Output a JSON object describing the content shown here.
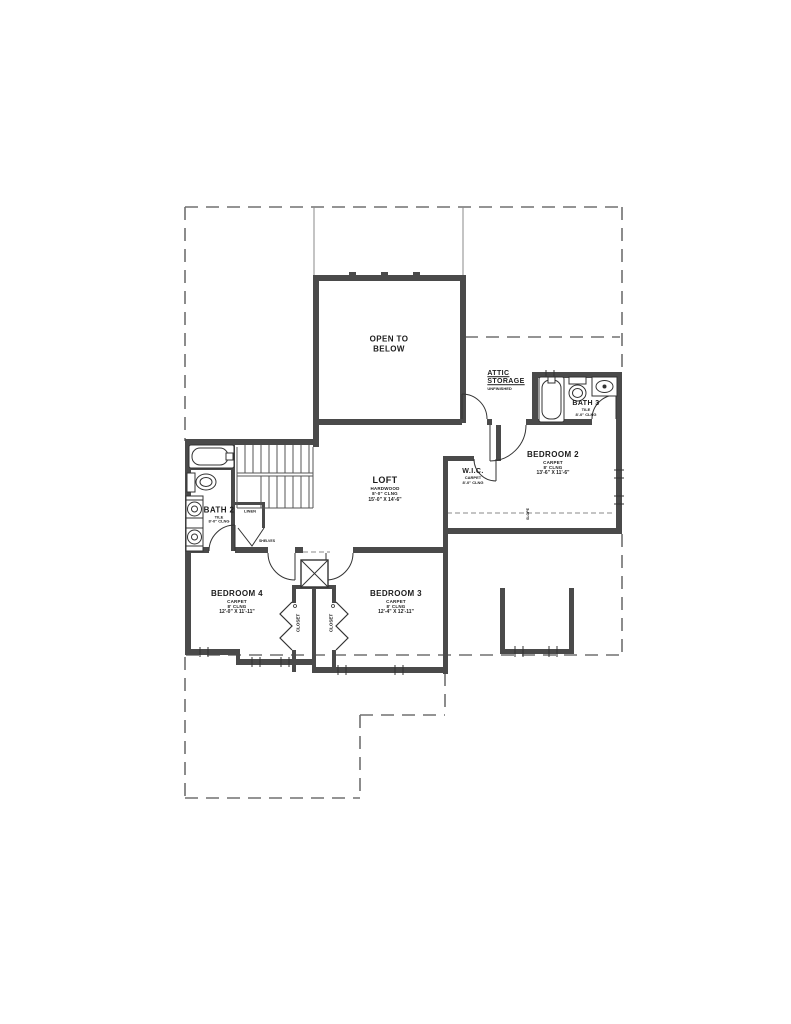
{
  "labels": {
    "open_to_below": {
      "line1": "OPEN TO",
      "line2": "BELOW"
    },
    "attic_storage": {
      "line1": "ATTIC",
      "line2": "STORAGE",
      "note": "UNFINISHED"
    },
    "bath3": {
      "name": "BATH 3",
      "finish": "TILE",
      "ceiling": "8'-0\" CLNG"
    },
    "bedroom2": {
      "name": "BEDROOM 2",
      "finish": "CARPET",
      "ceiling": "8' CLNG",
      "size": "13'-6\" X 11'-6\""
    },
    "wic": {
      "name": "W.I.C.",
      "finish": "CARPET",
      "ceiling": "8'-0\" CLNG"
    },
    "loft": {
      "name": "LOFT",
      "finish": "HARDWOOD",
      "ceiling": "8'-0\" CLNG",
      "size": "15'-0\" X 14'-6\""
    },
    "bath2": {
      "name": "BATH 2",
      "finish": "TILE",
      "ceiling": "8'-0\" CLNG"
    },
    "linen": {
      "name": "LINEN",
      "note": "SHELVES"
    },
    "bedroom4": {
      "name": "BEDROOM 4",
      "finish": "CARPET",
      "ceiling": "8' CLNG",
      "size": "12'-0\" X 11'-11\""
    },
    "bedroom3": {
      "name": "BEDROOM 3",
      "finish": "CARPET",
      "ceiling": "8' CLNG",
      "size": "12'-4\" X 12'-11\""
    },
    "closet_left": "CLOSET",
    "closet_right": "CLOSET",
    "slope": "SLOPE"
  },
  "colors": {
    "wall": "#4a4a4a",
    "line": "#333333",
    "dashed_outline": "#707070",
    "background": "#ffffff"
  }
}
